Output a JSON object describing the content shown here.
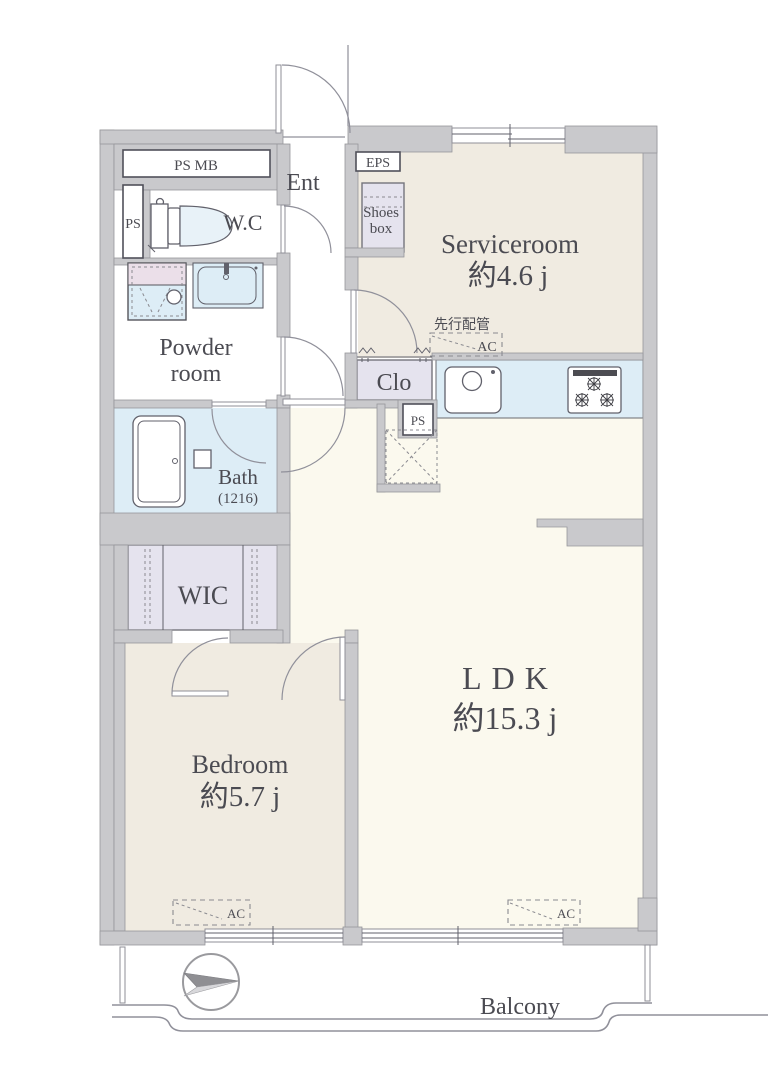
{
  "colors": {
    "wall": "#c9c9cc",
    "wall_outline": "#97979b",
    "floor_ldk": "#fbf9ee",
    "floor_room": "#f0ebe1",
    "floor_storage": "#e5e3ee",
    "floor_wet": "#ddedf6",
    "accent_pink": "#ebdfe9",
    "line": "#90909a",
    "text": "#4b4b52"
  },
  "rooms": {
    "serviceroom": {
      "name": "Serviceroom",
      "size": "約4.6 j"
    },
    "ldk": {
      "name": "LDK",
      "size": "約15.3 j"
    },
    "bedroom": {
      "name": "Bedroom",
      "size": "約5.7 j"
    },
    "bath": {
      "name": "Bath",
      "size": "(1216)"
    },
    "wic": {
      "name": "WIC"
    },
    "powder_room": {
      "line1": "Powder",
      "line2": "room"
    },
    "wc": {
      "name": "W.C"
    },
    "entrance": {
      "name": "Ent"
    },
    "closet": {
      "name": "Clo"
    },
    "balcony": {
      "name": "Balcony"
    }
  },
  "shafts": {
    "ps_mb": "PS MB",
    "ps_toilet": "PS",
    "eps": "EPS",
    "ps_kitchen": "PS"
  },
  "storage": {
    "shoes_box_line1": "Shoes",
    "shoes_box_line2": "box"
  },
  "annotations": {
    "ac": "AC",
    "advance_piping": "先行配管"
  }
}
